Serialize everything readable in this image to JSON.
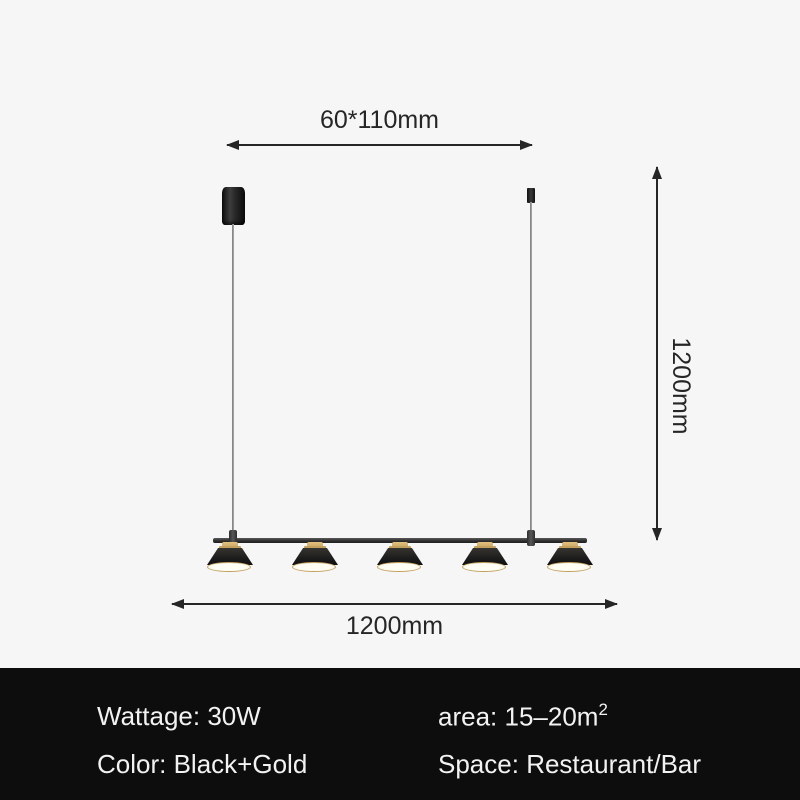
{
  "dimensions": {
    "canopy_size": "60*110mm",
    "drop_height": "1200mm",
    "length": "1200mm"
  },
  "specs": {
    "wattage": {
      "label": "Wattage:",
      "value": "30W"
    },
    "area": {
      "label": "area:",
      "value": "15–20m",
      "sup": "2"
    },
    "color": {
      "label": "Color:",
      "value": "Black+Gold"
    },
    "space": {
      "label": "Space:",
      "value": "Restaurant/Bar"
    }
  },
  "colors": {
    "background": "#f6f6f6",
    "footer_background": "#0d0d0d",
    "footer_text": "#f2f2f2",
    "dimension_line": "#262626",
    "fixture_black": "#1c1c1c",
    "accent_gold": "#c2a05e",
    "shade_diffuser": "#f3edd8"
  }
}
